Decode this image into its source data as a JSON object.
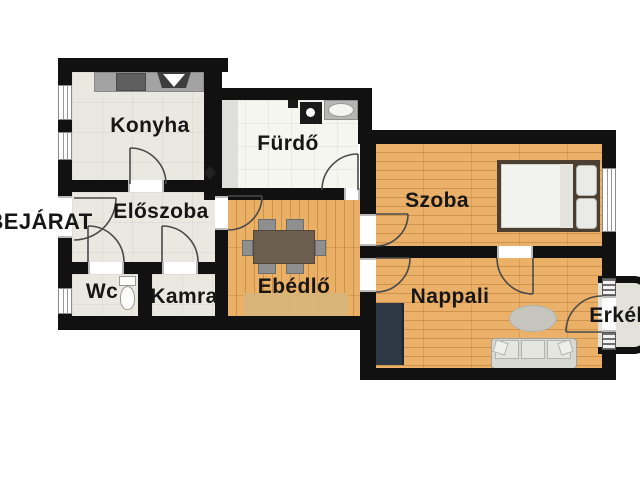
{
  "rooms": {
    "konyha": "Konyha",
    "furdo": "Fürdő",
    "eloszoba": "Előszoba",
    "wc": "Wc",
    "kamra": "Kamra",
    "ebedlo": "Ebédlő",
    "szoba": "Szoba",
    "nappali": "Nappali",
    "erkely": "Erkély",
    "bejarat": "BEJÁRAT"
  },
  "icons": [
    "kitchen-counter-icon",
    "stove-icon",
    "range-hood-icon",
    "washing-machine-icon",
    "sink-icon",
    "toilet-icon",
    "dining-table-icon",
    "chair-icon",
    "rug-icon",
    "bed-icon",
    "pillow-icon",
    "wardrobe-icon",
    "oval-rug-icon",
    "sofa-icon",
    "door-arc-icon",
    "window-icon",
    "diamond-marker-icon"
  ],
  "colors": {
    "wall": "#111111",
    "wood_floor": "#ecb169",
    "tile_floor": "#e9e9e1",
    "bath_floor": "#f6f6f1",
    "balcony_floor": "#e2e2db",
    "table": "#6b5e4f",
    "wardrobe": "#2c3844",
    "background": "#ffffff"
  }
}
